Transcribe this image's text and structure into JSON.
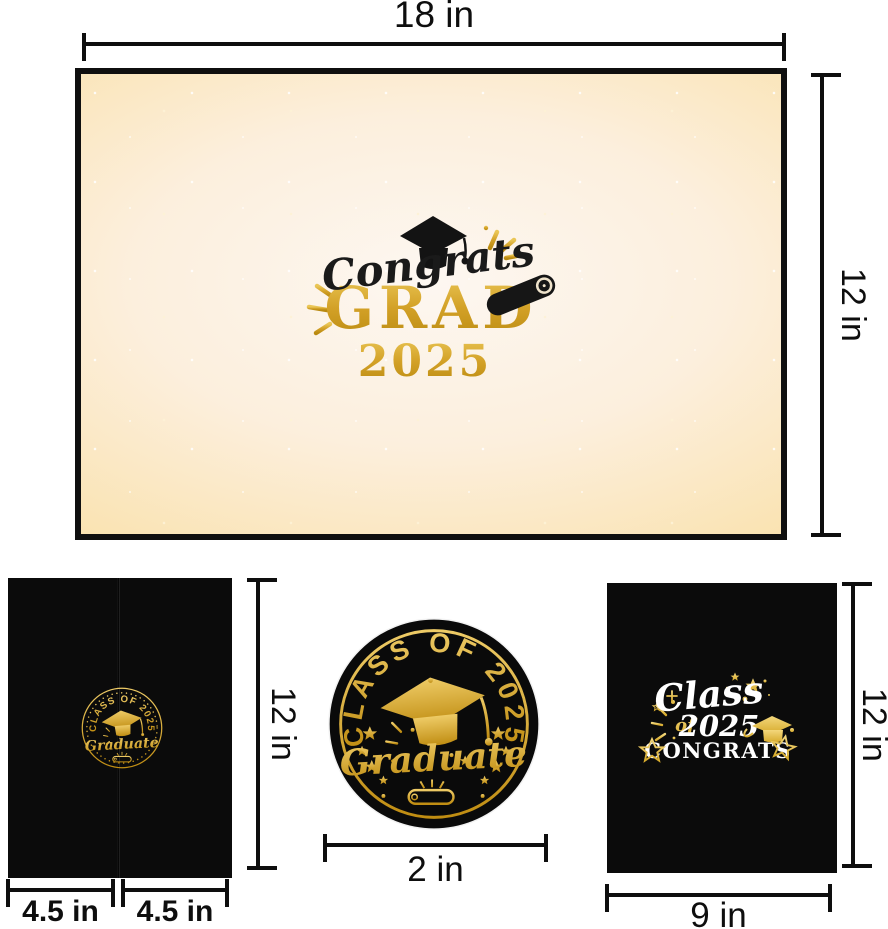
{
  "colors": {
    "gold": "#d2a02a",
    "gold_bright": "#eecb66",
    "gold_dark": "#c08d12",
    "black_item": "#0b0b0b",
    "cream": "#fae3b2",
    "white": "#ffffff",
    "measure_line": "#0e0e0e"
  },
  "dimensions": {
    "backdrop_width": "18 in",
    "backdrop_height": "12 in",
    "folder_height": "12 in",
    "folder_left_panel_width": "4.5 in",
    "folder_right_panel_width": "4.5 in",
    "sticker_diameter": "2 in",
    "card_width": "9 in",
    "card_height": "12 in"
  },
  "backdrop": {
    "script_word": "Congrats",
    "big_word": "GRAD",
    "year": "2025"
  },
  "folder_badge": {
    "arc_text": "CLASS OF 2025",
    "script_word": "Graduate"
  },
  "sticker_badge": {
    "arc_text": "CLASS OF 2025",
    "script_word": "Graduate"
  },
  "card": {
    "script_word": "Class",
    "of_word": "of",
    "year": "2025",
    "congrats_word": "CONGRATS"
  },
  "icons": [
    "graduation-cap-icon",
    "diploma-scroll-icon",
    "star-icon",
    "sparkle-burst-icon"
  ]
}
